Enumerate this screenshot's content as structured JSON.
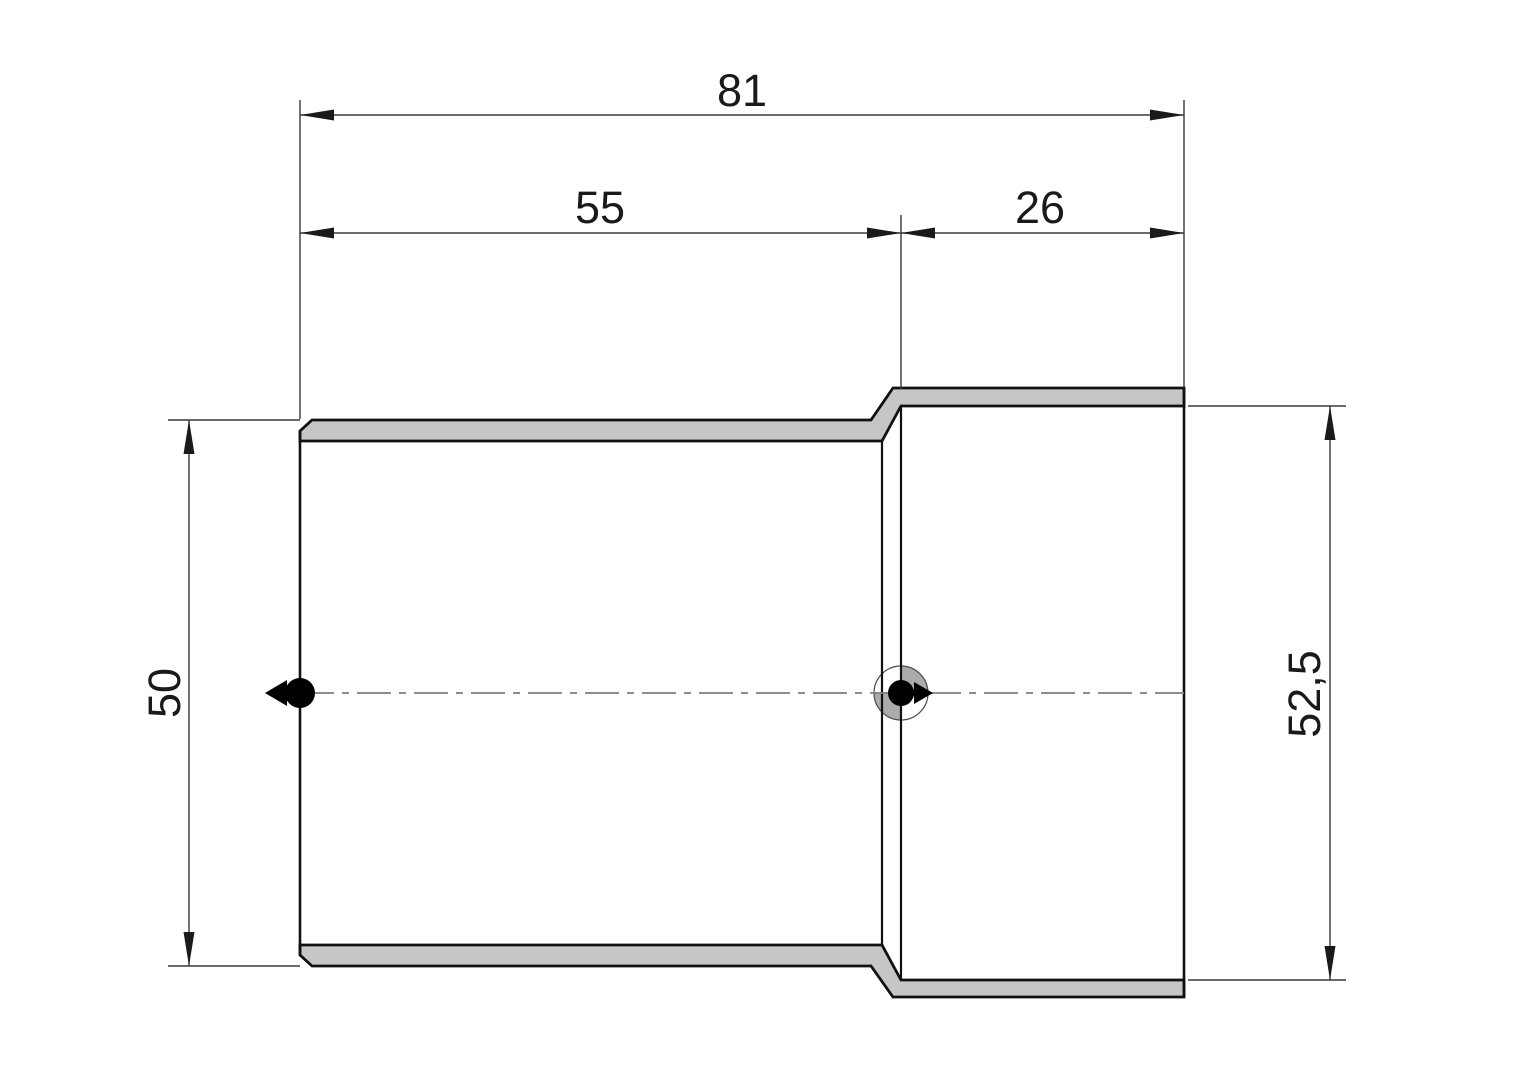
{
  "drawing": {
    "dimensions": {
      "overall_length": "81",
      "body_length": "55",
      "socket_depth": "26",
      "outer_diameter": "50",
      "socket_bore_diameter": "52,5"
    }
  },
  "colors": {
    "background": "#ffffff",
    "outline": "#111111",
    "wall_fill": "#c6c6c6",
    "dimension_line": "#3a3a3a",
    "arrow_fill": "#1a1a1a",
    "text_color": "#1a1a1a",
    "centerline": "#7f7f7f",
    "quadrant_gray": "#ababab",
    "marker_fill": "#000000"
  }
}
